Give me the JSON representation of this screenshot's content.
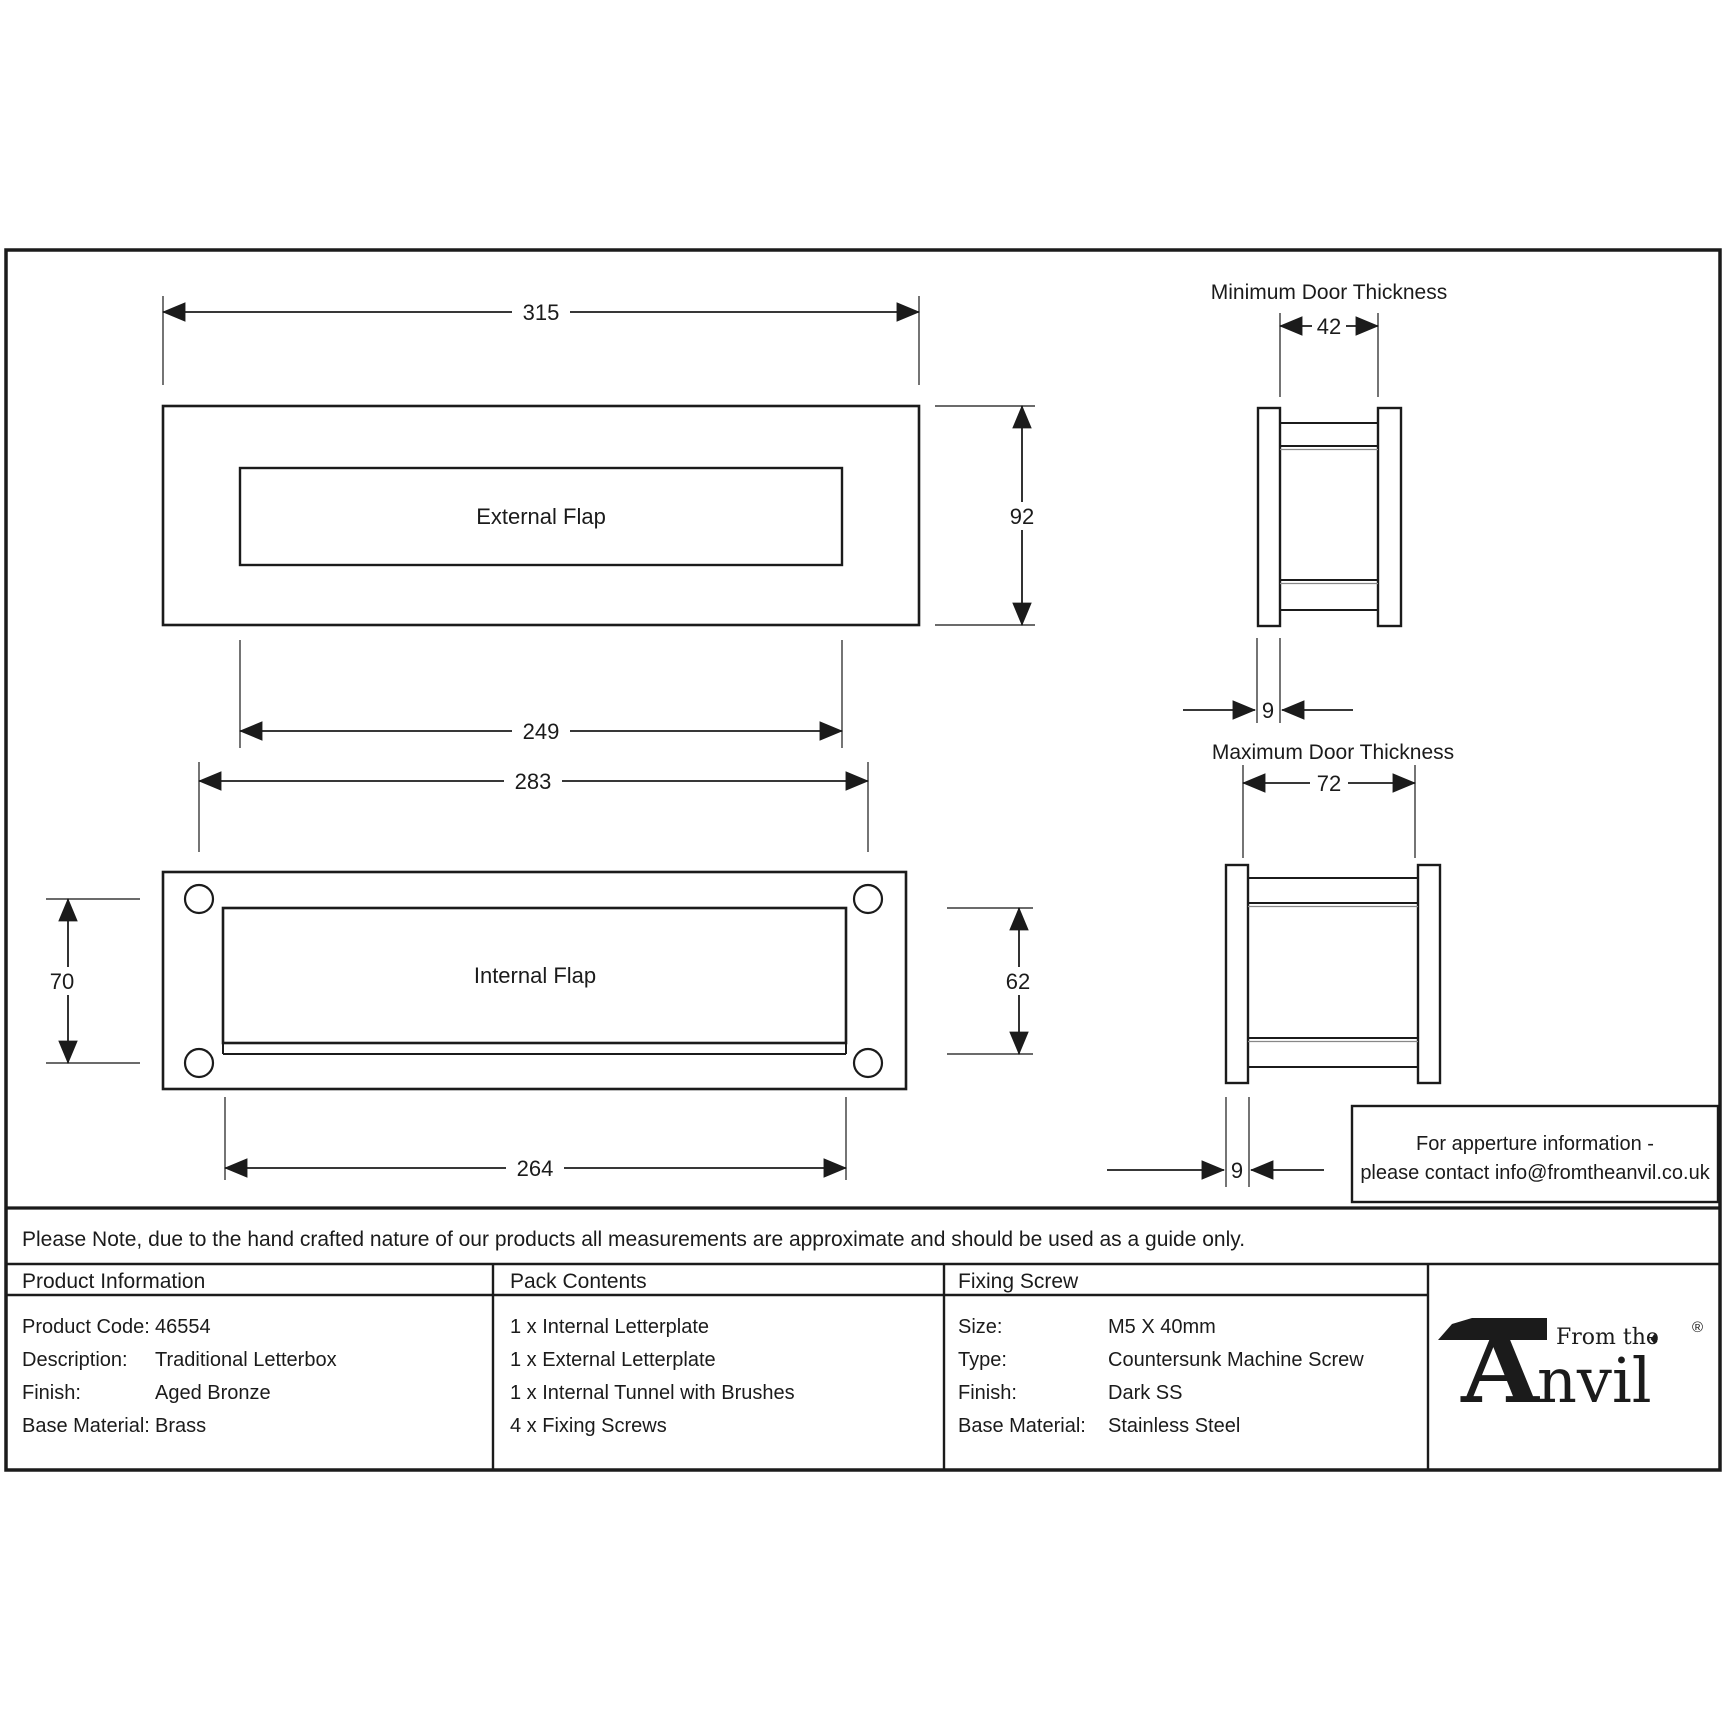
{
  "colors": {
    "ink": "#1b1b1b",
    "paper": "#ffffff"
  },
  "drawings": {
    "external": {
      "flap_label": "External Flap",
      "width": "315",
      "height": "92",
      "inner_width": "249",
      "hole_spacing": "283"
    },
    "internal": {
      "flap_label": "Internal Flap",
      "hole_height": "70",
      "aperture_height": "62",
      "aperture_width": "264"
    },
    "min_door": {
      "title": "Minimum Door Thickness",
      "thickness": "42",
      "plate_depth": "9"
    },
    "max_door": {
      "title": "Maximum Door Thickness",
      "thickness": "72",
      "plate_depth": "9"
    }
  },
  "aperture_box": {
    "line1": "For apperture information -",
    "line2": "please contact info@fromtheanvil.co.uk"
  },
  "disclaimer": "Please Note, due to the hand crafted nature of our products all measurements are approximate and should be used as a guide only.",
  "table": {
    "product_information": {
      "header": "Product Information",
      "rows": [
        {
          "label": "Product Code:",
          "value": "46554"
        },
        {
          "label": "Description:",
          "value": "Traditional Letterbox"
        },
        {
          "label": "Finish:",
          "value": "Aged Bronze"
        },
        {
          "label": "Base Material:",
          "value": "Brass"
        }
      ]
    },
    "pack_contents": {
      "header": "Pack Contents",
      "items": [
        "1 x Internal Letterplate",
        "1 x External Letterplate",
        "1 x Internal Tunnel with Brushes",
        "4 x Fixing Screws"
      ]
    },
    "fixing_screw": {
      "header": "Fixing Screw",
      "rows": [
        {
          "label": "Size:",
          "value": "M5 X 40mm"
        },
        {
          "label": "Type:",
          "value": "Countersunk Machine Screw"
        },
        {
          "label": "Finish:",
          "value": "Dark SS"
        },
        {
          "label": "Base Material:",
          "value": "Stainless Steel"
        }
      ]
    }
  },
  "logo": {
    "from_the": "From the",
    "diamond": "♦",
    "initial": "A",
    "rest": "nvil",
    "registered": "®"
  }
}
